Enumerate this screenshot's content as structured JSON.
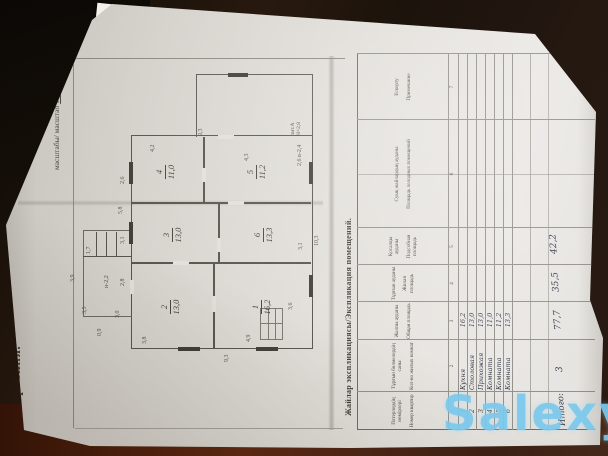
{
  "photo": {
    "watermark": "Salexy"
  },
  "title_block": {
    "title": "План строения.",
    "scale_label": "масштабы/ масштаб",
    "scale_value": "1 : 100"
  },
  "plan": {
    "litera": "лит.А",
    "litera_height": "Н=2,8",
    "rooms": [
      {
        "num": "1",
        "area": "16,2"
      },
      {
        "num": "2",
        "area": "13,0"
      },
      {
        "num": "3",
        "area": "13,0"
      },
      {
        "num": "4",
        "area": "11,0"
      },
      {
        "num": "5",
        "area": "11,2"
      },
      {
        "num": "6",
        "area": "13,3"
      }
    ],
    "dims": [
      {
        "t": "9,3"
      },
      {
        "t": "10,3"
      },
      {
        "t": "9,3"
      },
      {
        "t": "3,8"
      },
      {
        "t": "4,9"
      },
      {
        "t": "3,6"
      },
      {
        "t": "5,8"
      },
      {
        "t": "2,6"
      },
      {
        "t": "2,8"
      },
      {
        "t": "4,2"
      },
      {
        "t": "4,3"
      },
      {
        "t": "3,1"
      },
      {
        "t": "3,1"
      },
      {
        "t": "3,9"
      },
      {
        "t": "3,5"
      },
      {
        "t": "1,7"
      },
      {
        "t": "н-2,2"
      },
      {
        "t": "0,9"
      },
      {
        "t": "3,0"
      },
      {
        "t": "2,6 в-2,4"
      }
    ]
  },
  "table": {
    "title": "Жайлар экспликациясы/Экспликация помещений.",
    "columns": [
      {
        "kk": "Пәтерлердің нөмірлері",
        "ru": "Номер квартир",
        "n": "1"
      },
      {
        "kk": "Тұрғын бөлмелердің саны",
        "ru": "Кол-во жилых комнат",
        "n": "2"
      },
      {
        "kk": "Жалпы ауданы",
        "ru": "Общая площадь",
        "n": "3"
      },
      {
        "kk": "Тұрғын ауданы",
        "ru": "Жилая площадь",
        "n": "4"
      },
      {
        "kk": "Қосалқы ауданы",
        "ru": "Подсобная площадь",
        "n": "5"
      },
      {
        "kk": "Суық жайлардың ауданы",
        "ru": "Площадь холодных помещений",
        "n": "6"
      },
      {
        "kk": "Ескерту",
        "ru": "Примечание",
        "n": "7"
      }
    ],
    "rows": [
      {
        "num": "1",
        "name": "Кухня",
        "area": "16,2"
      },
      {
        "num": "2",
        "name": "Столовая",
        "area": "13,0"
      },
      {
        "num": "3",
        "name": "Прихожая",
        "area": "13,0"
      },
      {
        "num": "4",
        "name": "Комната",
        "area": "11,0"
      },
      {
        "num": "5",
        "name": "Комната",
        "area": "11,2"
      },
      {
        "num": "6",
        "name": "Комната",
        "area": "13,3"
      }
    ],
    "totals": {
      "label": "Итого:",
      "room_count": "3",
      "total_area": "77,7",
      "living_area": "35,5",
      "aux_area": "42,2"
    }
  }
}
